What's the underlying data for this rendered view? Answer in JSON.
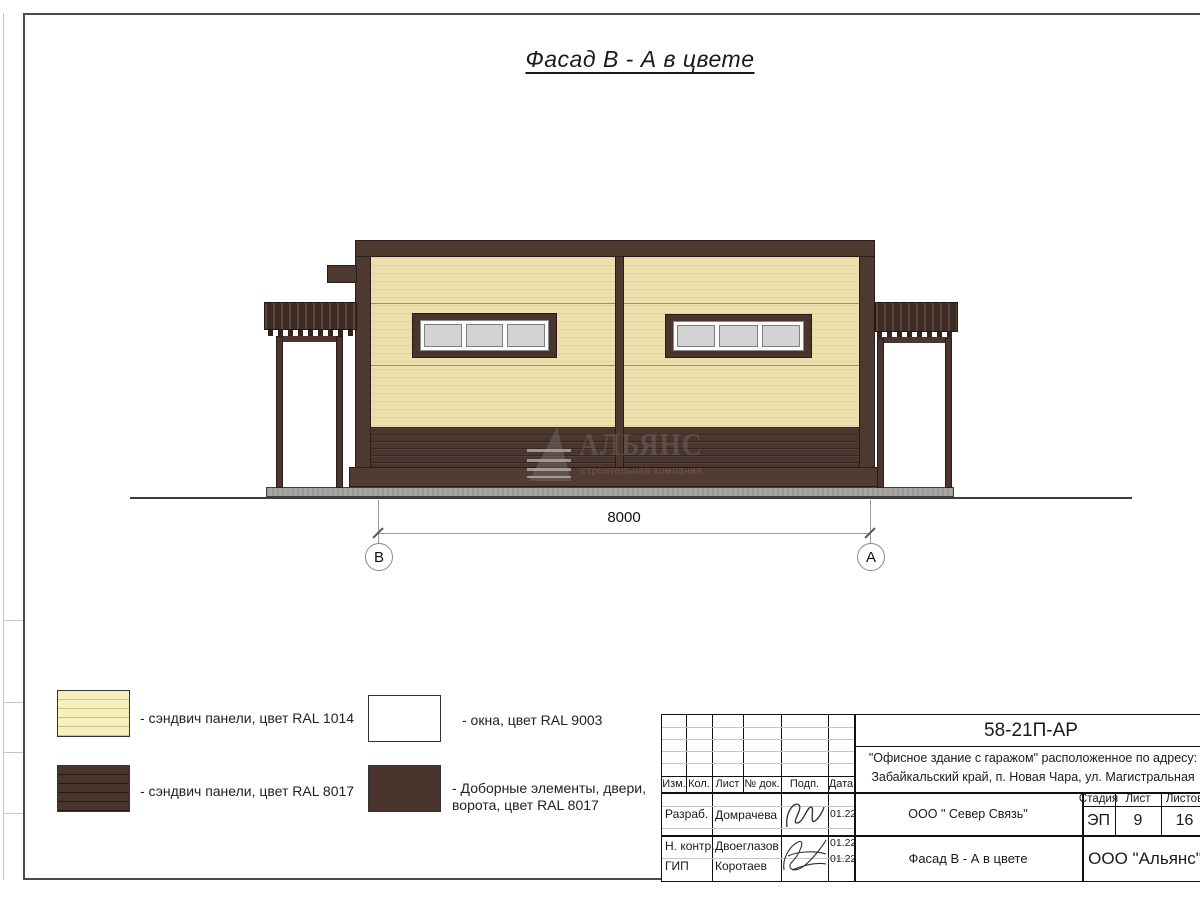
{
  "page": {
    "title": "Фасад В - А в цвете"
  },
  "colors": {
    "panel_light_ral1014": "#EDE0AC",
    "panel_dark_ral8017": "#4A362E",
    "trim_brown": "#4E3931",
    "window_pane_ral9003": "#D3D3D3",
    "concrete_pad": "#A5A5A1"
  },
  "drawing": {
    "dimension": "8000",
    "axis_left": "В",
    "axis_right": "А",
    "watermark": {
      "name": "АЛЬЯНС",
      "tagline": "строительная компания"
    }
  },
  "legend": {
    "items": [
      {
        "label": "- сэндвич панели, цвет RAL 1014"
      },
      {
        "label": "- сэндвич панели, цвет RAL 8017"
      },
      {
        "label": "- окна, цвет RAL 9003"
      },
      {
        "label": "- Доборные элементы, двери, ворота, цвет RAL 8017"
      }
    ]
  },
  "title_block": {
    "doc_code": "58-21П-АР",
    "project_line1": "\"Офисное здание с гаражом\" расположенное по адресу:",
    "project_line2": "Забайкальский край, п. Новая Чара, ул. Магистральная",
    "columns": {
      "izm": "Изм.",
      "kol": "Кол.",
      "list": "Лист",
      "dok": "№ док.",
      "podp": "Подп.",
      "data": "Дата"
    },
    "rows": [
      {
        "role": "Разраб.",
        "name": "Домрачева",
        "date": "01.22"
      },
      {
        "role": "Н. контр.",
        "name": "Двоеглазов",
        "date": "01.22"
      },
      {
        "role": "ГИП",
        "name": "Коротаев",
        "date": "01.22"
      }
    ],
    "client": "ООО \" Север Связь\"",
    "stage_label": "Стадия",
    "stage_value": "ЭП",
    "sheet_label": "Лист",
    "sheet_value": "9",
    "sheets_label": "Листов",
    "sheets_value": "16",
    "sheet_title": "Фасад В - А в цвете",
    "company": "ООО \"Альянс\""
  }
}
